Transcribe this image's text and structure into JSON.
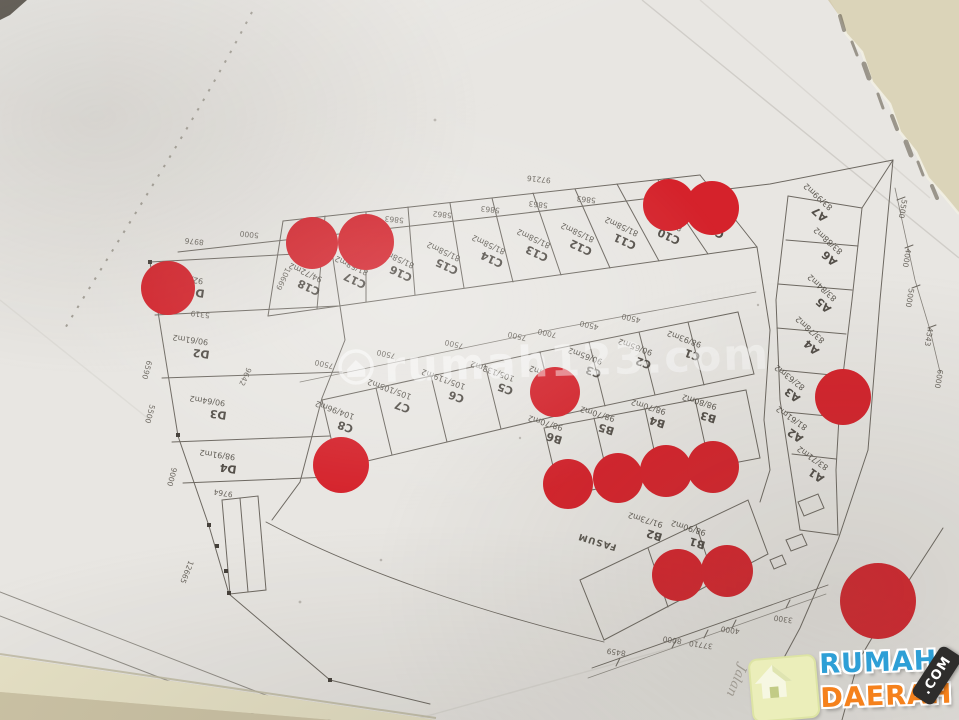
{
  "watermark": {
    "text": "rumah123.com"
  },
  "logo": {
    "word1": "RUMAH",
    "word2": "DAERAH",
    "badge": ".COM"
  },
  "site_plan": {
    "street_label": "Jalan",
    "lots": [
      {
        "id": "D1",
        "area": "92/65m2"
      },
      {
        "id": "D2",
        "area": "90/61m2"
      },
      {
        "id": "D3",
        "area": "90/64m2"
      },
      {
        "id": "D4",
        "area": "98/91m2"
      },
      {
        "id": "C18",
        "area": "94/72m2"
      },
      {
        "id": "C17",
        "area": "81/58m2"
      },
      {
        "id": "C16",
        "area": "81/58m2"
      },
      {
        "id": "C15",
        "area": "81/58m2"
      },
      {
        "id": "C14",
        "area": "81/58m2"
      },
      {
        "id": "C13",
        "area": "81/58m2"
      },
      {
        "id": "C12",
        "area": "81/58m2"
      },
      {
        "id": "C11",
        "area": "81/58m2"
      },
      {
        "id": "C10",
        "area": "81/58m2"
      },
      {
        "id": "C9",
        "area": "4m2"
      },
      {
        "id": "C8",
        "area": "104/96m2"
      },
      {
        "id": "C7",
        "area": "105/105m2"
      },
      {
        "id": "C6",
        "area": "105/119m2"
      },
      {
        "id": "C5",
        "area": "105/133m2"
      },
      {
        "id": "C4",
        "area": "90/65m2"
      },
      {
        "id": "C3",
        "area": "90/65m2"
      },
      {
        "id": "C2",
        "area": "90/65m2"
      },
      {
        "id": "C1",
        "area": "98/93m2"
      },
      {
        "id": "B6",
        "area": "98/70m2"
      },
      {
        "id": "B5",
        "area": "98/70m2"
      },
      {
        "id": "B4",
        "area": "98/70m2"
      },
      {
        "id": "B3",
        "area": "98/80m2"
      },
      {
        "id": "B2",
        "area": "91/73m2"
      },
      {
        "id": "B1",
        "area": "98/90m2"
      },
      {
        "id": "FASUM",
        "area": ""
      },
      {
        "id": "A7",
        "area": "83/99m2"
      },
      {
        "id": "A6",
        "area": "83/88m2"
      },
      {
        "id": "A5",
        "area": "83/84m2"
      },
      {
        "id": "A4",
        "area": "83/78m2"
      },
      {
        "id": "A3",
        "area": "82/63m2"
      },
      {
        "id": "A2",
        "area": "81/61m2"
      },
      {
        "id": "A1",
        "area": "83/71m2"
      }
    ],
    "dimensions": [
      {
        "v": "8976"
      },
      {
        "v": "5000"
      },
      {
        "v": "5863"
      },
      {
        "v": "5862"
      },
      {
        "v": "5863"
      },
      {
        "v": "5863"
      },
      {
        "v": "5863"
      },
      {
        "v": "97216"
      },
      {
        "v": "10669"
      },
      {
        "v": "5319"
      },
      {
        "v": "6590"
      },
      {
        "v": "9642"
      },
      {
        "v": "5500"
      },
      {
        "v": "9000"
      },
      {
        "v": "9764"
      },
      {
        "v": "12665"
      },
      {
        "v": "7500"
      },
      {
        "v": "7500"
      },
      {
        "v": "7500"
      },
      {
        "v": "7500"
      },
      {
        "v": "7000"
      },
      {
        "v": "4500"
      },
      {
        "v": "4500"
      },
      {
        "v": "8459"
      },
      {
        "v": "8000"
      },
      {
        "v": "37710"
      },
      {
        "v": "4000"
      },
      {
        "v": "3300"
      },
      {
        "v": "5500"
      },
      {
        "v": "4000"
      },
      {
        "v": "5000"
      },
      {
        "v": "4343"
      },
      {
        "v": "6000"
      }
    ]
  }
}
